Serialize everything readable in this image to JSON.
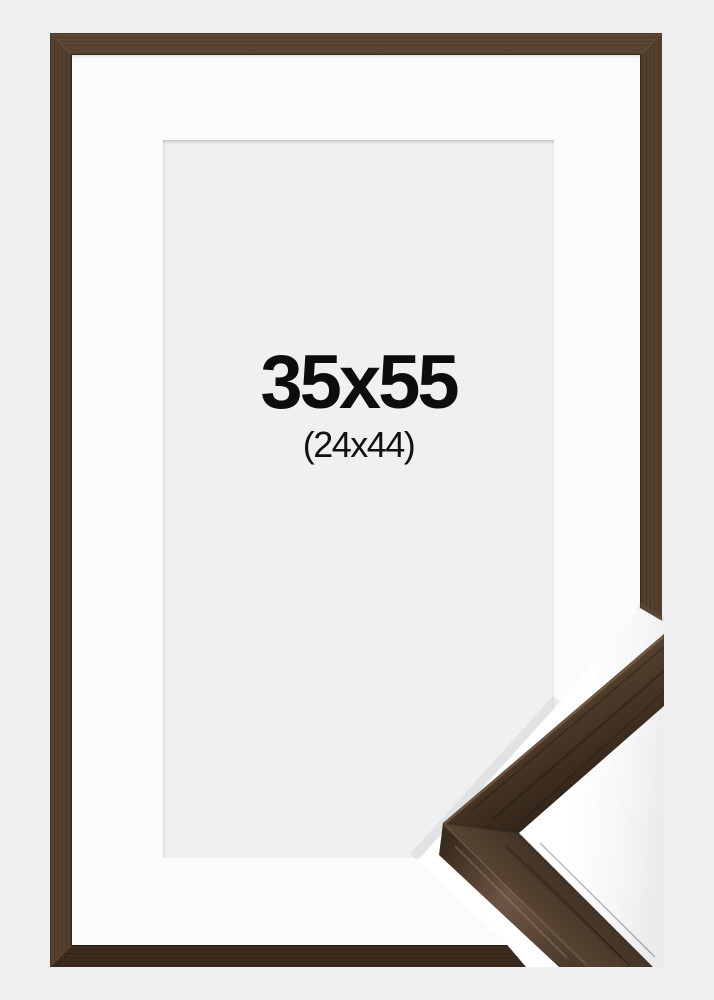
{
  "product_image": {
    "outer_size_label": "35x55",
    "inner_size_label": "(24x44)"
  },
  "scene": {
    "description_elements": [
      "walnut-picture-frame",
      "white-mat",
      "gray-opening",
      "corner-profile-sample"
    ],
    "colors": {
      "page_background": "#f0f0f2",
      "mat": "#fbfbfc",
      "opening": "#eff0f1",
      "label_text": "#0d0d0d",
      "wood_light": "#5b4633",
      "wood_mid": "#4d3828",
      "wood_dark": "#3a2a1c",
      "wood_highlight": "#8a6f53",
      "sample_backing": "#ffffff"
    }
  }
}
